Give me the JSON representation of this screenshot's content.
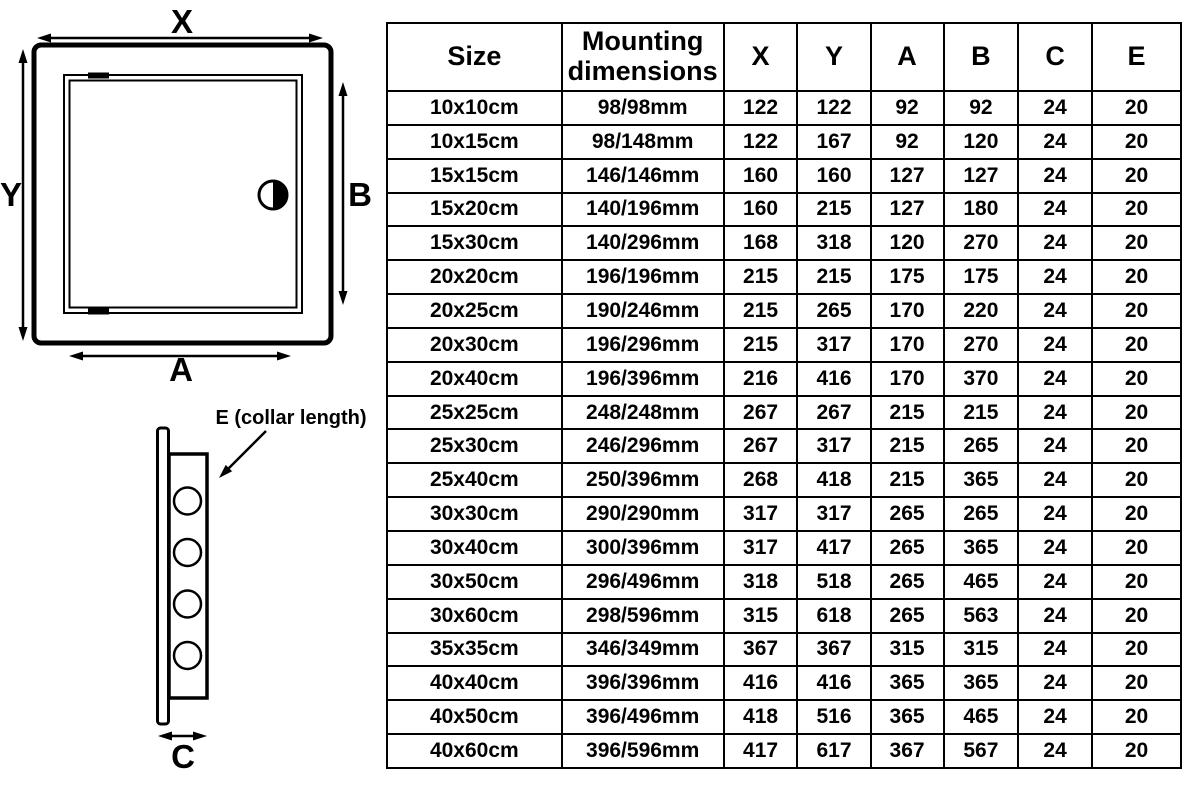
{
  "colors": {
    "line": "#000000",
    "background": "#ffffff",
    "text": "#000000"
  },
  "diagram": {
    "front_view": {
      "width_label": "X",
      "height_label": "Y",
      "opening_width_label": "A",
      "opening_height_label": "B"
    },
    "side_view": {
      "collar_label": "E (collar length)",
      "depth_label": "C"
    }
  },
  "table": {
    "headers": [
      "Size",
      "Mounting dimensions",
      "X",
      "Y",
      "A",
      "B",
      "C",
      "E"
    ],
    "rows": [
      [
        "10x10cm",
        "98/98mm",
        "122",
        "122",
        "92",
        "92",
        "24",
        "20"
      ],
      [
        "10x15cm",
        "98/148mm",
        "122",
        "167",
        "92",
        "120",
        "24",
        "20"
      ],
      [
        "15x15cm",
        "146/146mm",
        "160",
        "160",
        "127",
        "127",
        "24",
        "20"
      ],
      [
        "15x20cm",
        "140/196mm",
        "160",
        "215",
        "127",
        "180",
        "24",
        "20"
      ],
      [
        "15x30cm",
        "140/296mm",
        "168",
        "318",
        "120",
        "270",
        "24",
        "20"
      ],
      [
        "20x20cm",
        "196/196mm",
        "215",
        "215",
        "175",
        "175",
        "24",
        "20"
      ],
      [
        "20x25cm",
        "190/246mm",
        "215",
        "265",
        "170",
        "220",
        "24",
        "20"
      ],
      [
        "20x30cm",
        "196/296mm",
        "215",
        "317",
        "170",
        "270",
        "24",
        "20"
      ],
      [
        "20x40cm",
        "196/396mm",
        "216",
        "416",
        "170",
        "370",
        "24",
        "20"
      ],
      [
        "25x25cm",
        "248/248mm",
        "267",
        "267",
        "215",
        "215",
        "24",
        "20"
      ],
      [
        "25x30cm",
        "246/296mm",
        "267",
        "317",
        "215",
        "265",
        "24",
        "20"
      ],
      [
        "25x40cm",
        "250/396mm",
        "268",
        "418",
        "215",
        "365",
        "24",
        "20"
      ],
      [
        "30x30cm",
        "290/290mm",
        "317",
        "317",
        "265",
        "265",
        "24",
        "20"
      ],
      [
        "30x40cm",
        "300/396mm",
        "317",
        "417",
        "265",
        "365",
        "24",
        "20"
      ],
      [
        "30x50cm",
        "296/496mm",
        "318",
        "518",
        "265",
        "465",
        "24",
        "20"
      ],
      [
        "30x60cm",
        "298/596mm",
        "315",
        "618",
        "265",
        "563",
        "24",
        "20"
      ],
      [
        "35x35cm",
        "346/349mm",
        "367",
        "367",
        "315",
        "315",
        "24",
        "20"
      ],
      [
        "40x40cm",
        "396/396mm",
        "416",
        "416",
        "365",
        "365",
        "24",
        "20"
      ],
      [
        "40x50cm",
        "396/496mm",
        "418",
        "516",
        "365",
        "465",
        "24",
        "20"
      ],
      [
        "40x60cm",
        "396/596mm",
        "417",
        "617",
        "367",
        "567",
        "24",
        "20"
      ]
    ]
  }
}
